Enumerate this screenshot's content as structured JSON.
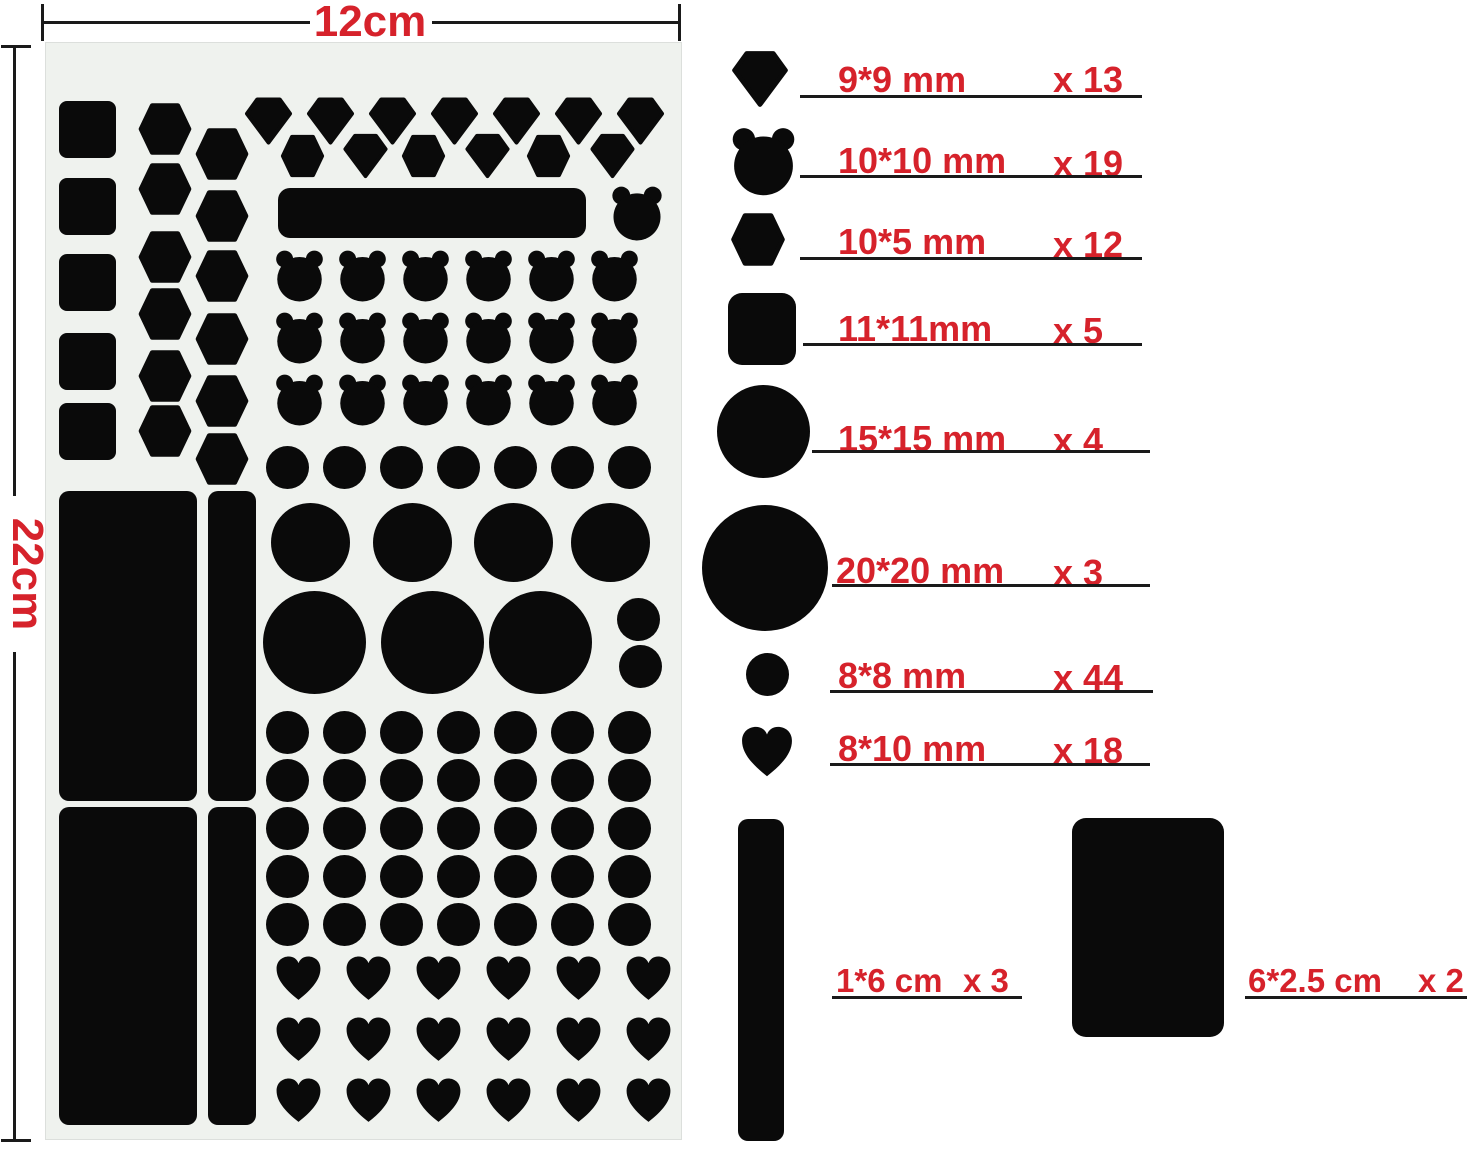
{
  "colors": {
    "shape_black": "#0a0a0a",
    "accent_red": "#d6222b",
    "sheet_background": "#eff2ee",
    "line_black": "#1a1a1a"
  },
  "dimensions": {
    "width_label": "12cm",
    "height_label": "22cm"
  },
  "legend": {
    "rows": [
      {
        "icon": "diamond-icon",
        "size": "9*9 mm",
        "count": "x 13"
      },
      {
        "icon": "bear-icon",
        "size": "10*10 mm",
        "count": "x 19"
      },
      {
        "icon": "hexagon-icon",
        "size": "10*5 mm",
        "count": "x 12"
      },
      {
        "icon": "square-icon",
        "size": "11*11mm",
        "count": "x 5"
      },
      {
        "icon": "circle-icon",
        "size": "15*15 mm",
        "count": "x 4"
      },
      {
        "icon": "large-circle-icon",
        "size": "20*20 mm",
        "count": "x 3"
      },
      {
        "icon": "small-circle-icon",
        "size": "8*8 mm",
        "count": "x 44"
      },
      {
        "icon": "heart-icon",
        "size": "8*10 mm",
        "count": "x 18"
      }
    ]
  },
  "strips": {
    "strip": {
      "size": "1*6 cm",
      "count": "x 3"
    },
    "patch": {
      "size": "6*2.5 cm",
      "count": "x 2"
    }
  }
}
